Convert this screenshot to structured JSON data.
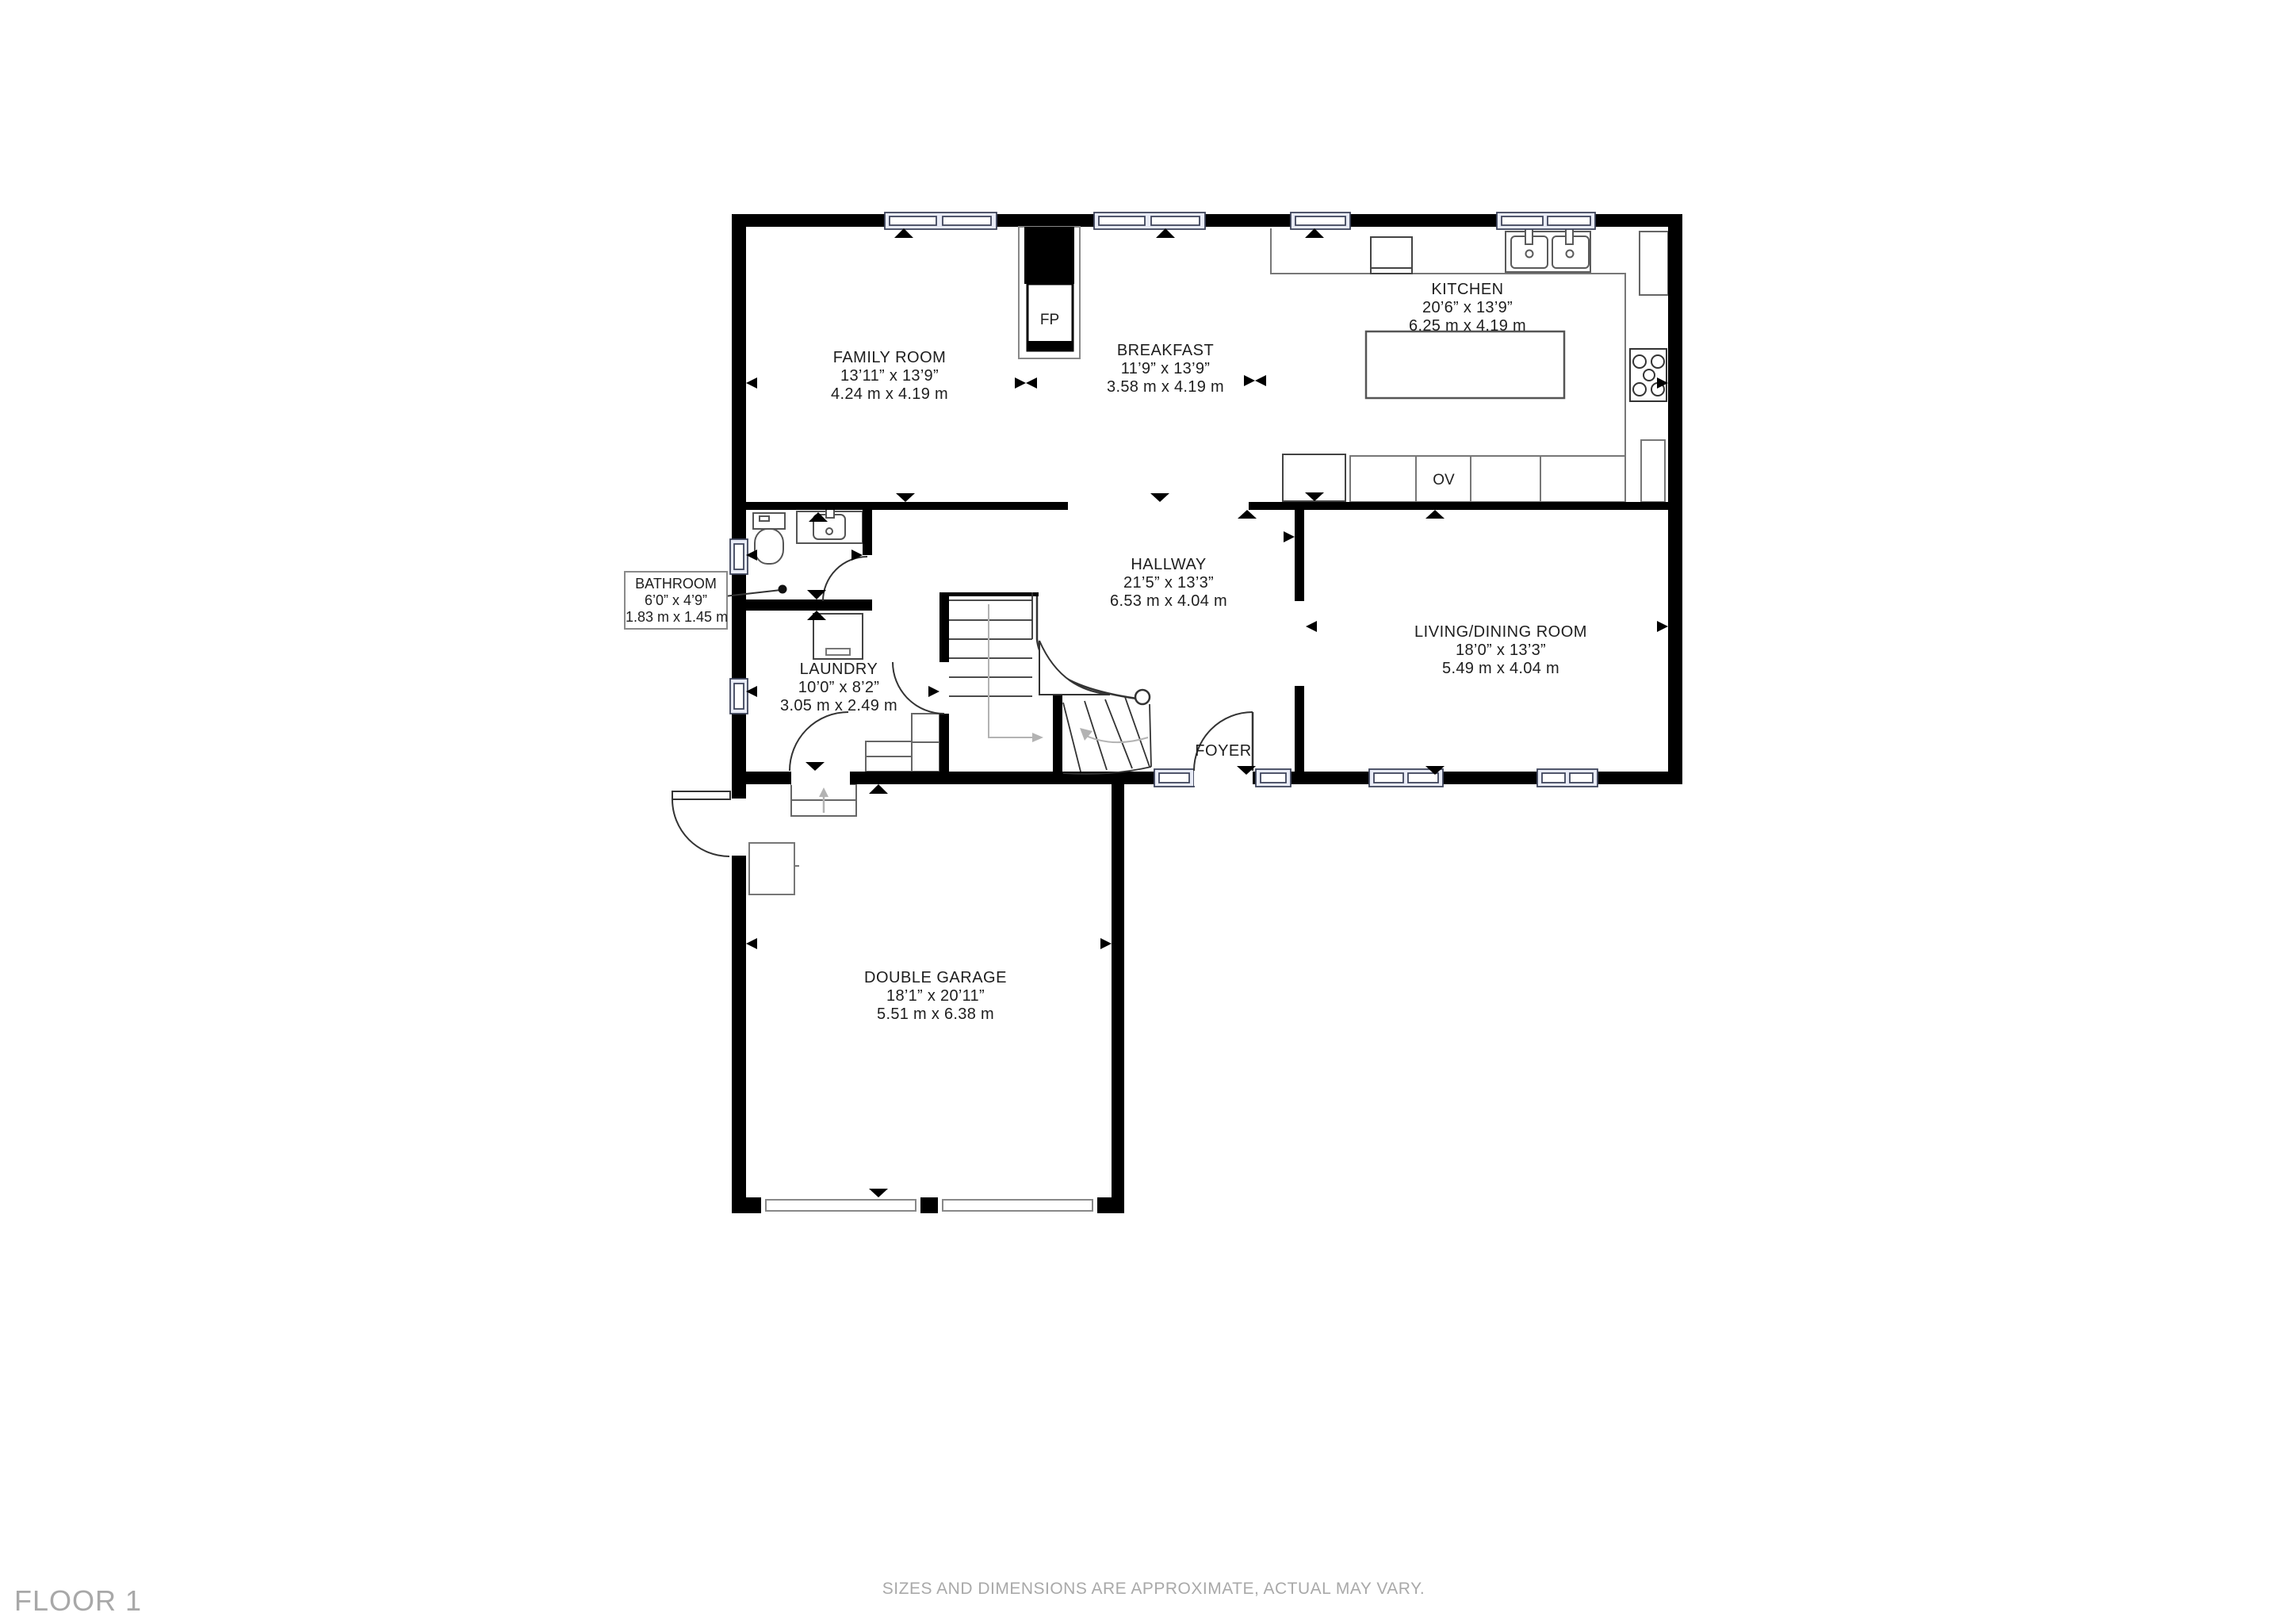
{
  "rooms": {
    "family_room": {
      "name": "FAMILY ROOM",
      "imperial": "13’11” x 13’9”",
      "metric": "4.24 m x 4.19 m"
    },
    "breakfast": {
      "name": "BREAKFAST",
      "imperial": "11’9” x 13’9”",
      "metric": "3.58 m x 4.19 m"
    },
    "kitchen": {
      "name": "KITCHEN",
      "imperial": "20’6” x 13’9”",
      "metric": "6.25 m x 4.19 m"
    },
    "bathroom": {
      "name": "BATHROOM",
      "imperial": "6’0” x 4’9”",
      "metric": "1.83 m x 1.45 m"
    },
    "hallway": {
      "name": "HALLWAY",
      "imperial": "21’5” x 13’3”",
      "metric": "6.53 m x 4.04 m"
    },
    "living_dining": {
      "name": "LIVING/DINING ROOM",
      "imperial": "18’0” x 13’3”",
      "metric": "5.49 m x 4.04 m"
    },
    "laundry": {
      "name": "LAUNDRY",
      "imperial": "10’0” x 8’2”",
      "metric": "3.05 m x 2.49 m"
    },
    "foyer": {
      "name": "FOYER"
    },
    "garage": {
      "name": "DOUBLE GARAGE",
      "imperial": "18’1” x 20’11”",
      "metric": "5.51 m x 6.38 m"
    }
  },
  "fixtures": {
    "fireplace_label": "FP",
    "oven_label": "OV"
  },
  "footer": {
    "floor_label": "FLOOR 1",
    "disclaimer": "SIZES AND DIMENSIONS ARE APPROXIMATE, ACTUAL MAY VARY."
  },
  "colors": {
    "wall": "#000000",
    "window_fill": "#e8ebf6",
    "window_stroke": "#3f455c",
    "fixture_stroke": "#555555",
    "muted_text": "#a9a9a9",
    "label_text": "#1e1e1e"
  }
}
